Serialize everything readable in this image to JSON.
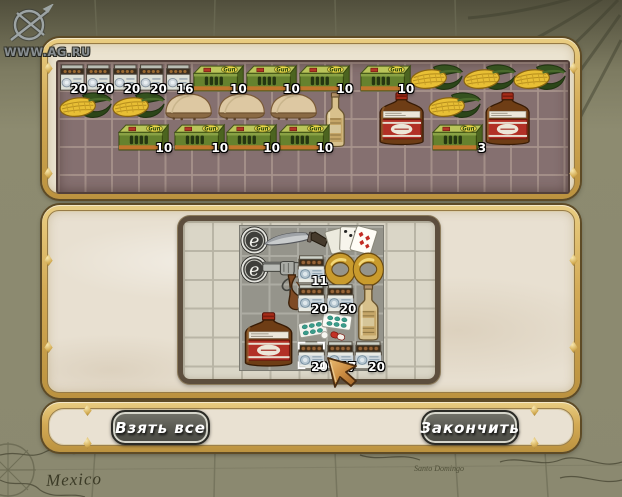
{
  "watermark": {
    "site": "WWW.AG.RU",
    "icon": "compass-icon"
  },
  "map_background": {
    "labels": [
      {
        "id": "mexico",
        "text": "Mexico"
      },
      {
        "id": "santo-domingo",
        "text": "Santo Domingo"
      }
    ]
  },
  "colors": {
    "frame_gold": "#d3aa55",
    "frame_outline": "#5e4b26",
    "panel_cream": "#ebe3d0",
    "inventory_grid_brown": "#857070",
    "container_border": "#5d4e3d",
    "container_cells_light": "#dad6c7",
    "loot_cells_dark": "#95948b",
    "button_fill": "#57574f",
    "button_text": "#ffffff",
    "map_olive": "#8b8970",
    "count_text": "#ffffff"
  },
  "player_panel": {
    "name": "party-inventory",
    "grid": {
      "cols": 19,
      "rows": 4
    },
    "items": [
      {
        "type": "cartridge-pack",
        "col": 1,
        "row": 1,
        "count": "20"
      },
      {
        "type": "cartridge-pack",
        "col": 2,
        "row": 1,
        "count": "20"
      },
      {
        "type": "cartridge-pack",
        "col": 3,
        "row": 1,
        "count": "20"
      },
      {
        "type": "cartridge-pack",
        "col": 4,
        "row": 1,
        "count": "20"
      },
      {
        "type": "cartridge-pack",
        "col": 5,
        "row": 1,
        "count": "16"
      },
      {
        "type": "ammo-box-green",
        "col": 6,
        "row": 1,
        "w": 2,
        "count": "10"
      },
      {
        "type": "ammo-box-green",
        "col": 8,
        "row": 1,
        "w": 2,
        "count": "10"
      },
      {
        "type": "ammo-box-green",
        "col": 10,
        "row": 1,
        "w": 2,
        "count": "10"
      },
      {
        "type": "ammo-box-green",
        "col": 12.3,
        "row": 1,
        "w": 2,
        "count": "10"
      },
      {
        "type": "corn",
        "col": 14.2,
        "row": 1,
        "w": 2
      },
      {
        "type": "corn",
        "col": 16.2,
        "row": 1,
        "w": 2
      },
      {
        "type": "corn",
        "col": 18.1,
        "row": 1,
        "w": 2
      },
      {
        "type": "corn",
        "col": 1,
        "row": 2,
        "w": 2
      },
      {
        "type": "corn",
        "col": 3,
        "row": 2,
        "w": 2
      },
      {
        "type": "bread",
        "col": 4.9,
        "row": 2,
        "w": 2
      },
      {
        "type": "bread",
        "col": 6.9,
        "row": 2,
        "w": 2
      },
      {
        "type": "bread",
        "col": 8.85,
        "row": 2,
        "w": 2
      },
      {
        "type": "bottle-tall",
        "col": 10.9,
        "row": 2,
        "h": 2
      },
      {
        "type": "bottle-whiskey",
        "col": 12.9,
        "row": 2,
        "w": 2,
        "h": 2
      },
      {
        "type": "corn",
        "col": 14.9,
        "row": 2,
        "w": 2
      },
      {
        "type": "bottle-whiskey",
        "col": 16.9,
        "row": 2,
        "w": 2,
        "h": 2
      },
      {
        "type": "ammo-box-green",
        "col": 3.2,
        "row": 3.1,
        "w": 2,
        "count": "10"
      },
      {
        "type": "ammo-box-green",
        "col": 5.3,
        "row": 3.1,
        "w": 2,
        "count": "10"
      },
      {
        "type": "ammo-box-green",
        "col": 7.25,
        "row": 3.1,
        "w": 2,
        "count": "10"
      },
      {
        "type": "ammo-box-green",
        "col": 9.25,
        "row": 3.1,
        "w": 2,
        "count": "10"
      },
      {
        "type": "ammo-box-green",
        "col": 15,
        "row": 3.1,
        "w": 2,
        "count": "3"
      }
    ]
  },
  "loot_panel": {
    "name": "loot-container",
    "grid": {
      "cols": 5,
      "rows": 5
    },
    "items": [
      {
        "type": "coin-e",
        "col": 1,
        "row": 1
      },
      {
        "type": "knife",
        "col": 1.8,
        "row": 1,
        "w": 2.3
      },
      {
        "type": "playing-cards",
        "col": 3.85,
        "row": 1,
        "w": 2.15
      },
      {
        "type": "coin-e",
        "col": 1,
        "row": 2
      },
      {
        "type": "revolver",
        "col": 1.75,
        "row": 2,
        "w": 2,
        "h": 2
      },
      {
        "type": "ammo-box-white",
        "col": 3,
        "row": 2,
        "count": "11"
      },
      {
        "type": "gold-ring",
        "col": 4,
        "row": 2
      },
      {
        "type": "gold-ring",
        "col": 5,
        "row": 2
      },
      {
        "type": "ammo-box-white",
        "col": 3,
        "row": 3,
        "count": "20"
      },
      {
        "type": "ammo-box-white",
        "col": 4,
        "row": 3,
        "count": "20"
      },
      {
        "type": "bottle-tall",
        "col": 5,
        "row": 3,
        "h": 2
      },
      {
        "type": "pills",
        "col": 3,
        "row": 4,
        "w": 2
      },
      {
        "type": "bottle-whiskey",
        "col": 1,
        "row": 4,
        "w": 2,
        "h": 2
      },
      {
        "type": "ammo-box-white",
        "col": 3,
        "row": 5,
        "count": "20",
        "selected": true
      },
      {
        "type": "ammo-box-white",
        "col": 4,
        "row": 5,
        "count": "17"
      },
      {
        "type": "ammo-box-white",
        "col": 5,
        "row": 5,
        "count": "20"
      }
    ]
  },
  "buttons": {
    "take_all": "Взять все",
    "finish": "Закончить"
  },
  "cursor": {
    "type": "arrow-cursor"
  }
}
